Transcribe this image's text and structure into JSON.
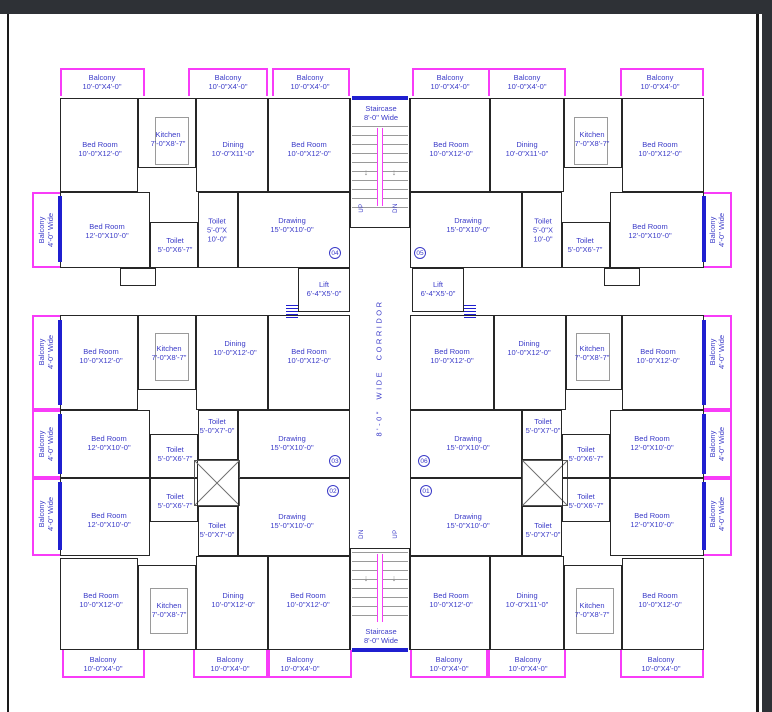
{
  "colors": {
    "wall": "#262626",
    "balcony_outline": "#f83cf8",
    "label_text": "#3a3ac8",
    "blue_accent": "#1f1fd0",
    "frame_dark": "#2e3136",
    "minor_lines": "#9a9a9a"
  },
  "rooms": {
    "balcony_top": {
      "name": "Balcony",
      "size": "10'-0\"X4'-0\""
    },
    "balcony_side": {
      "name": "Balcony",
      "size": "4'-0\" Wide"
    },
    "bed_10x12": {
      "name": "Bed Room",
      "size": "10'-0\"X12'-0\""
    },
    "bed_12x10": {
      "name": "Bed Room",
      "size": "12'-0\"X10'-0\""
    },
    "kitchen": {
      "name": "Kitchen",
      "size": "7'-0\"X8'-7\""
    },
    "dining_10x11": {
      "name": "Dining",
      "size": "10'-0\"X11'-0\""
    },
    "dining_10x12": {
      "name": "Dining",
      "size": "10'-0\"X12'-0\""
    },
    "drawing": {
      "name": "Drawing",
      "size": "15'-0\"X10'-0\""
    },
    "toilet_5x10": {
      "name": "Toilet",
      "size_l1": "5'-0\"X",
      "size_l2": "10'-0\""
    },
    "toilet_5x6_7": {
      "name": "Toilet",
      "size": "5'-0\"X6'-7\""
    },
    "toilet_5x7": {
      "name": "Toilet",
      "size": "5'-0\"X7'-0\""
    },
    "lift": {
      "name": "Lift",
      "size": "6'-4\"X5'-0\""
    },
    "staircase": {
      "name": "Staircase",
      "size": "8'-0\" Wide"
    }
  },
  "corridor": {
    "label": "8'-0\" WIDE CORRIDOR"
  },
  "stairs": {
    "up": "UP",
    "dn": "DN",
    "arrow": "↓"
  },
  "units": {
    "u01": "01",
    "u02": "02",
    "u03": "03",
    "u04": "04",
    "u05": "05",
    "u06": "06"
  }
}
